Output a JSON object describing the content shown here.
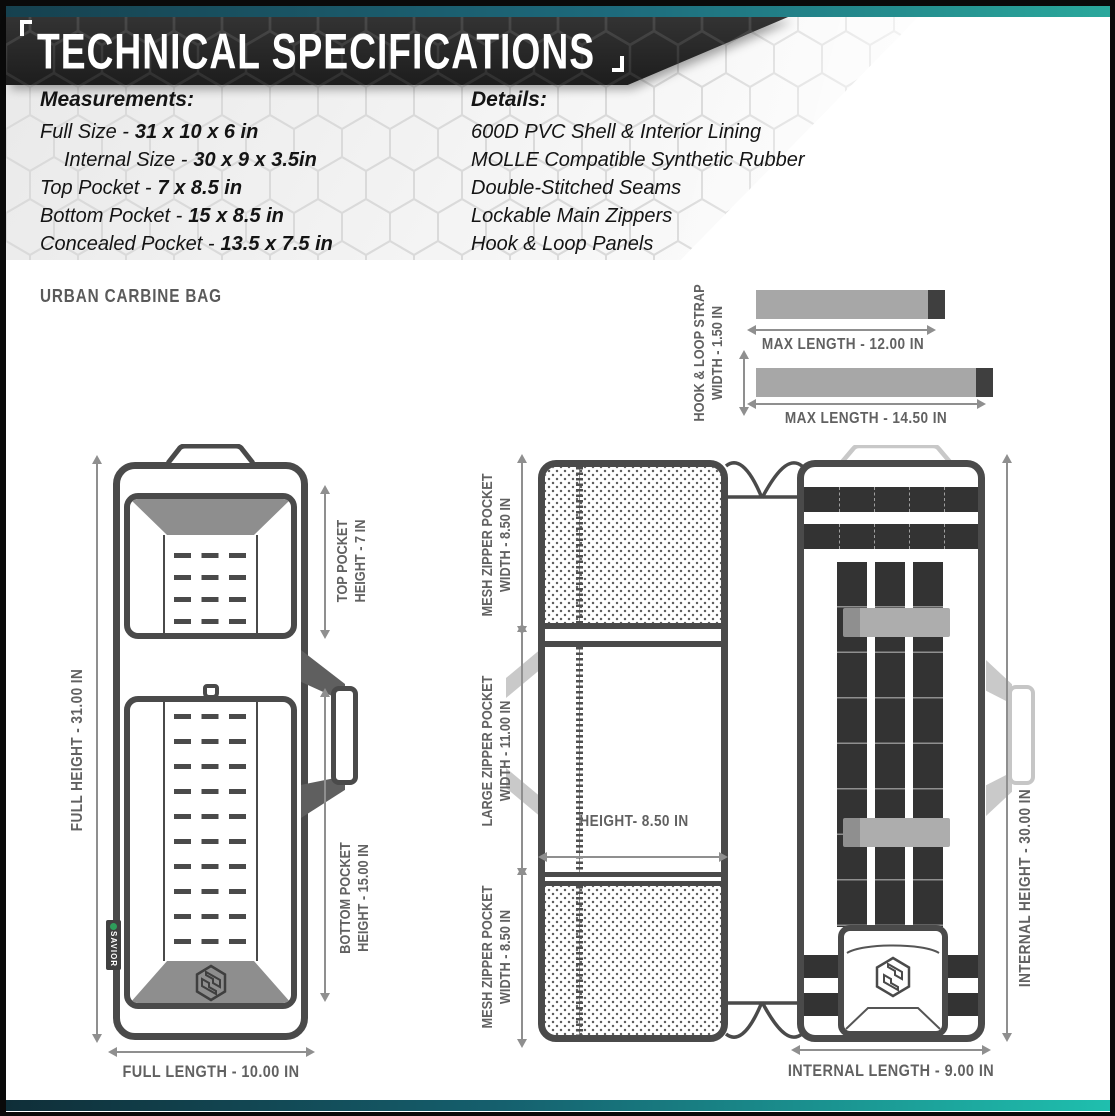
{
  "colors": {
    "accent_teal_dark": "#16414f",
    "accent_teal_bright": "#2aa89c",
    "header_background": "#282828",
    "title_text": "#ffffff",
    "outline_gray": "#4a4a4a",
    "annotation_gray": "#616161",
    "strap_gray": "#a7a7a7",
    "brand_green": "#2e9e5b"
  },
  "header": {
    "title": "TECHNICAL SPECIFICATIONS"
  },
  "measurements": {
    "heading": "Measurements:",
    "items": [
      {
        "label": "Full Size -",
        "value": "31 x 10 x 6 in"
      },
      {
        "label": "Internal Size -",
        "value": "30 x 9 x 3.5in"
      },
      {
        "label": "Top Pocket -",
        "value": "7 x 8.5 in"
      },
      {
        "label": "Bottom Pocket -",
        "value": "15 x 8.5 in"
      },
      {
        "label": "Concealed Pocket -",
        "value": "13.5 x 7.5 in"
      }
    ]
  },
  "details": {
    "heading": "Details:",
    "items": [
      "600D PVC Shell & Interior Lining",
      "MOLLE Compatible Synthetic Rubber",
      "Double-Stitched Seams",
      "Lockable Main Zippers",
      "Hook & Loop Panels"
    ]
  },
  "product_name": "URBAN CARBINE BAG",
  "strap_diagram": {
    "width_label": [
      "HOOK & LOOP STRAP",
      "WIDTH - 1.50 IN"
    ],
    "strap_1_label": "MAX LENGTH - 12.00 IN",
    "strap_2_label": "MAX LENGTH - 14.50 IN"
  },
  "front_view": {
    "full_height_label": "FULL HEIGHT - 31.00 IN",
    "top_pocket_label": [
      "TOP POCKET",
      "HEIGHT - 7 IN"
    ],
    "bottom_pocket_label": [
      "BOTTOM POCKET",
      "HEIGHT - 15.00 IN"
    ],
    "full_length_label": "FULL LENGTH - 10.00 IN",
    "brand_tag": "SAVIOR"
  },
  "inside_left_view": {
    "mesh_top_label": [
      "MESH ZIPPER POCKET",
      "WIDTH - 8.50 IN"
    ],
    "large_pocket_label": [
      "LARGE ZIPPER POCKET",
      "WIDTH - 11.00 IN"
    ],
    "mesh_bottom_label": [
      "MESH ZIPPER POCKET",
      "WIDTH - 8.50 IN"
    ],
    "height_label": "HEIGHT- 8.50 IN"
  },
  "inside_right_view": {
    "internal_height_label": "INTERNAL HEIGHT - 30.00 IN",
    "internal_length_label": "INTERNAL LENGTH - 9.00 IN"
  }
}
